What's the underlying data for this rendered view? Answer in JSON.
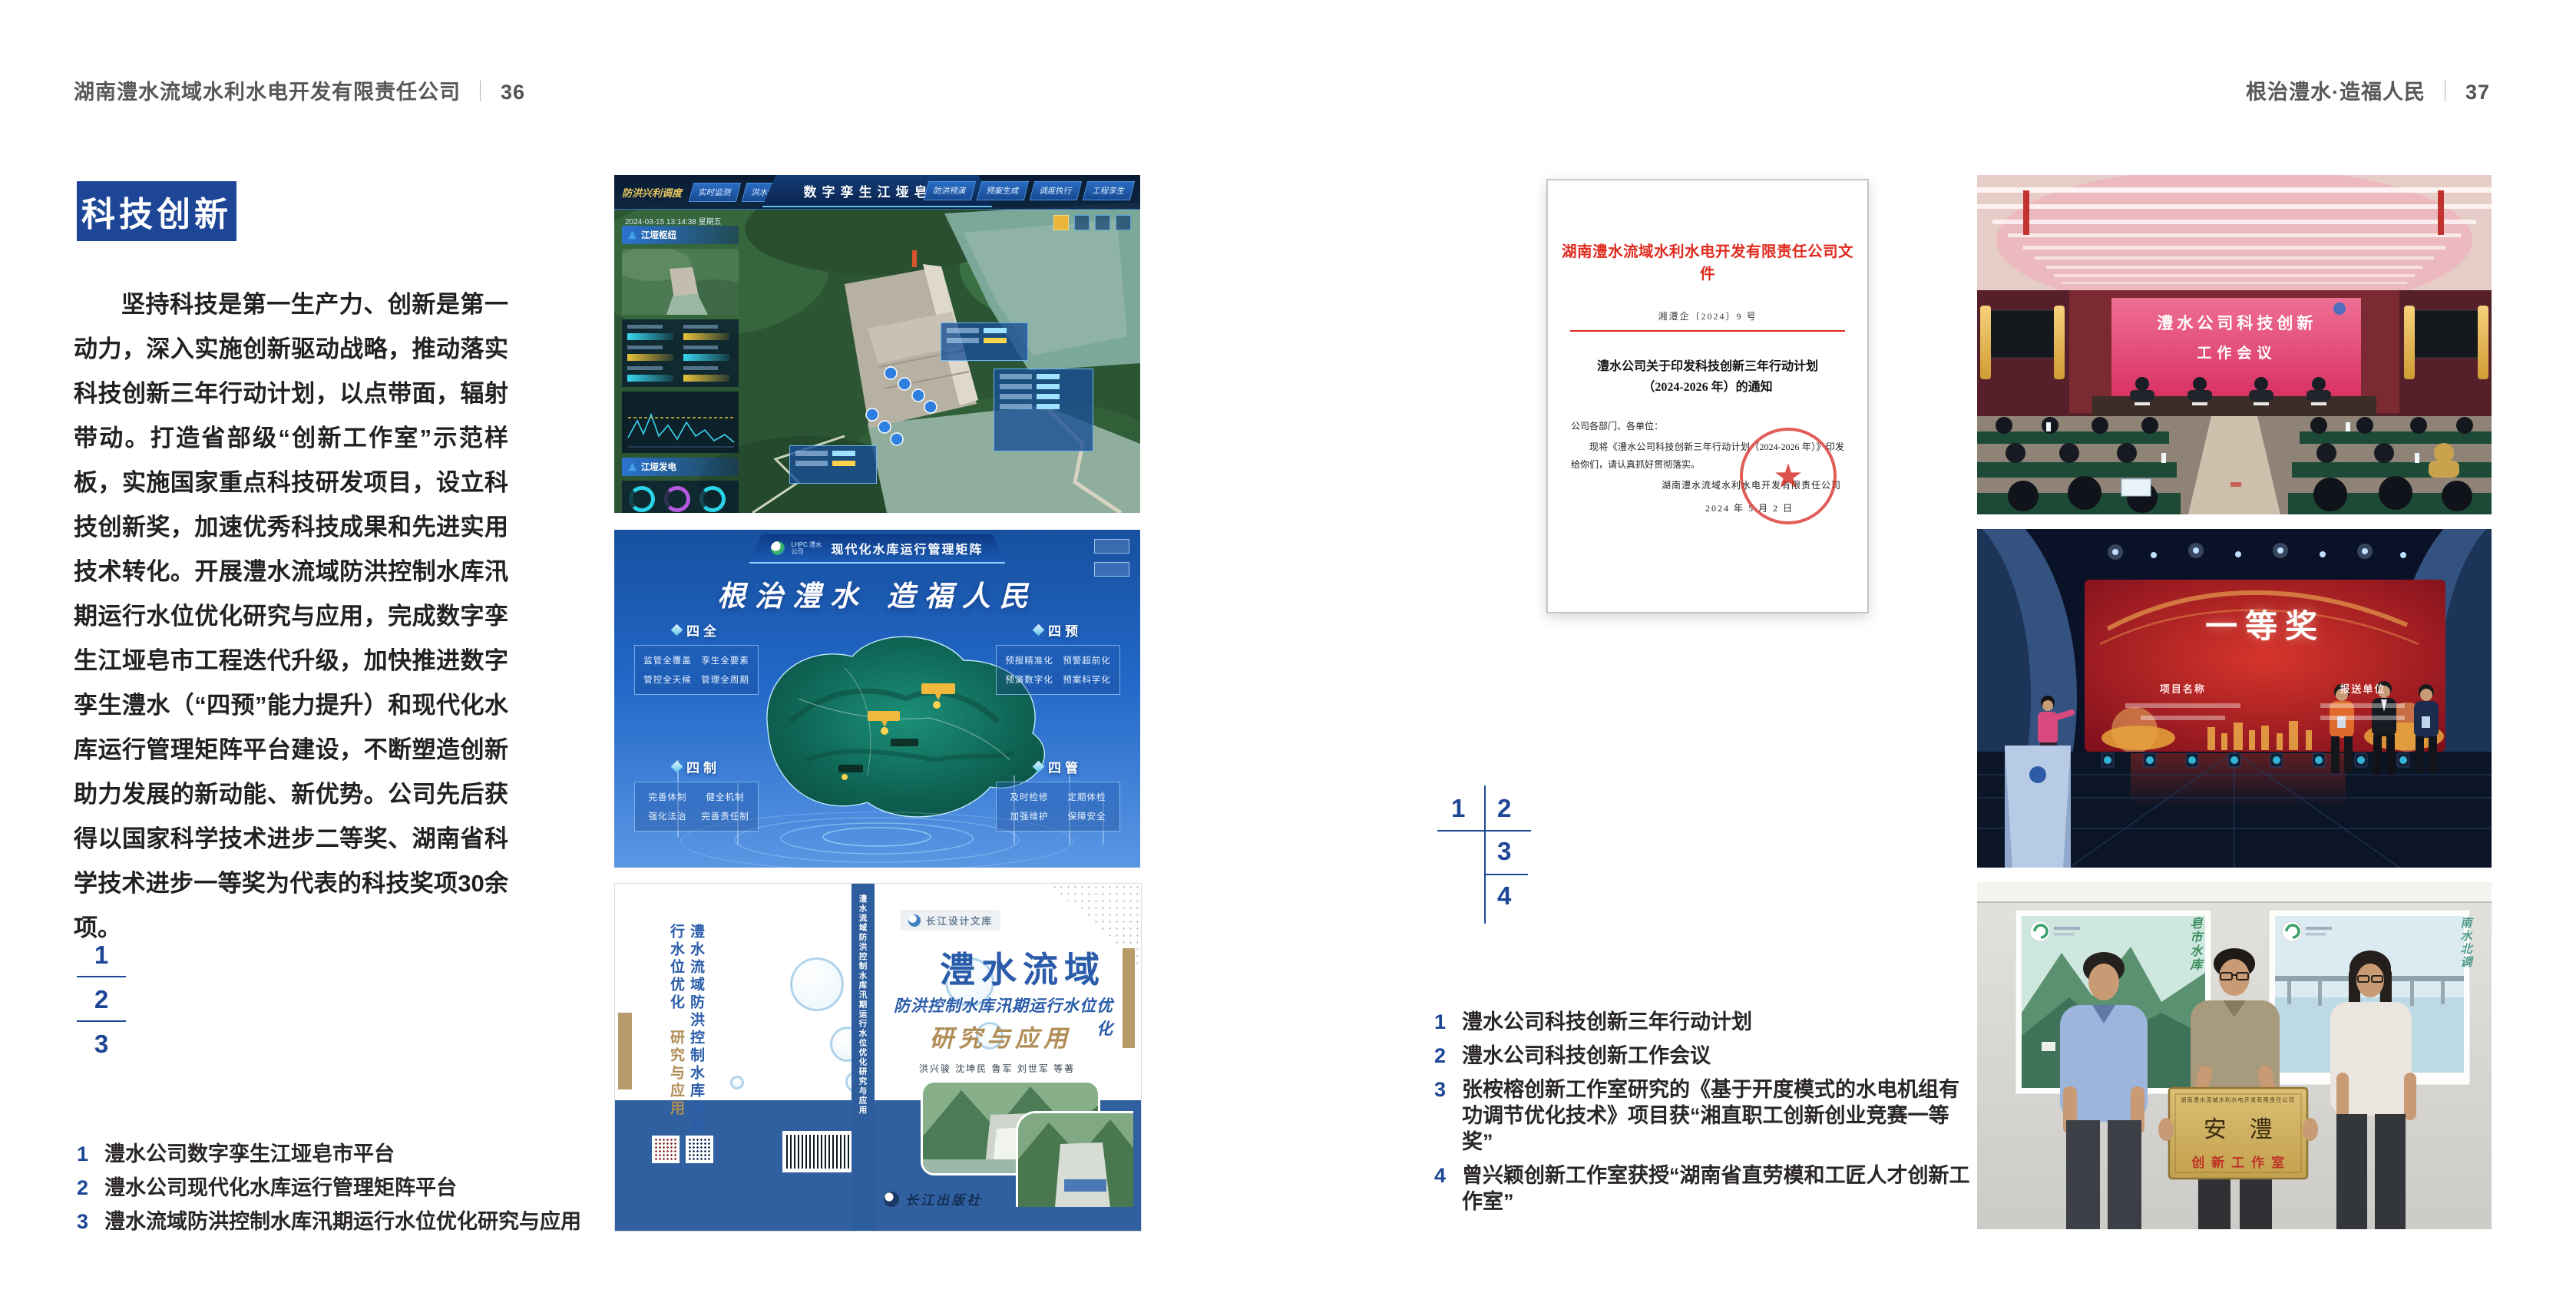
{
  "page_left": {
    "header": {
      "company": "湖南澧水流域水利水电开发有限责任公司",
      "separator": "｜",
      "page_no": "36"
    },
    "badge": "科技创新",
    "paragraph": "坚持科技是第一生产力、创新是第一动力，深入实施创新驱动战略，推动落实科技创新三年行动计划，以点带面，辐射带动。打造省部级“创新工作室”示范样板，实施国家重点科技研发项目，设立科技创新奖，加速优秀科技成果和先进实用技术转化。开展澧水流域防洪控制水库汛期运行水位优化研究与应用，完成数字孪生江垭皂市工程迭代升级，加快推进数字孪生澧水（“四预”能力提升）和现代化水库运行管理矩阵平台建设，不断塑造创新助力发展的新动能、新优势。公司先后获得以国家科学技术进步二等奖、湖南省科学技术进步一等奖为代表的科技奖项30余项。",
    "figure_numbers": [
      "1",
      "2",
      "3"
    ],
    "captions": [
      {
        "no": "1",
        "text": "澧水公司数字孪生江垭皂市平台"
      },
      {
        "no": "2",
        "text": "澧水公司现代化水库运行管理矩阵平台"
      },
      {
        "no": "3",
        "text": "澧水流域防洪控制水库汛期运行水位优化研究与应用"
      }
    ]
  },
  "page_right": {
    "header": {
      "motto": "根治澧水·造福人民",
      "separator": "｜",
      "page_no": "37"
    },
    "figure_numbers": [
      "1",
      "2",
      "3",
      "4"
    ],
    "captions": [
      {
        "no": "1",
        "text": "澧水公司科技创新三年行动计划"
      },
      {
        "no": "2",
        "text": "澧水公司科技创新工作会议"
      },
      {
        "no": "3",
        "text": "张桉榕创新工作室研究的《基于开度模式的水电机组有功调节优化技术》项目获“湘直职工创新创业竞赛一等奖”"
      },
      {
        "no": "4",
        "text": "曾兴颖创新工作室获授“湖南省直劳模和工匠人才创新工作室”"
      }
    ],
    "document": {
      "red_title": "湖南澧水流域水利水电开发有限责任公司文件",
      "doc_no": "湘澧企〔2024〕9 号",
      "subject_line1": "澧水公司关于印发科技创新三年行动计划",
      "subject_line2": "（2024-2026 年）的通知",
      "salutation": "公司各部门、各单位：",
      "body": "现将《澧水公司科技创新三年行动计划（2024-2026 年）》印发给你们，请认真抓好贯彻落实。",
      "signer": "湖南澧水流域水利水电开发有限责任公司",
      "date": "2024 年 5 月 2 日"
    }
  },
  "figures": {
    "digital_twin": {
      "corner_label": "防洪兴利调度",
      "tabs_left": [
        "实时监测",
        "洪水预报",
        "防洪预警"
      ],
      "title": "数字孪生江垭皂市",
      "tabs_right": [
        "防洪预演",
        "预案生成",
        "调度执行",
        "工程孪生"
      ],
      "timestamp": "2024-03-15 13:14:38 星期五",
      "panel_top_title": "江垭枢纽",
      "panel_bottom_title": "江垭发电"
    },
    "matrix": {
      "logo_text": "LHPC 澧水公司",
      "title": "现代化水库运行管理矩阵",
      "slogan": "根治澧水 造福人民",
      "panels": [
        {
          "title": "四全",
          "items": [
            "监管全覆盖",
            "孪生全要素",
            "管控全天候",
            "管理全周期"
          ]
        },
        {
          "title": "四制",
          "items": [
            "完善体制",
            "健全机制",
            "强化法治",
            "完善责任制"
          ]
        },
        {
          "title": "四预",
          "items": [
            "预报精准化",
            "预警超前化",
            "预演数字化",
            "预案科学化"
          ]
        },
        {
          "title": "四管",
          "items": [
            "及时检修",
            "定期体检",
            "加强维护",
            "保障安全"
          ]
        }
      ]
    },
    "book": {
      "series": "长江设计文库",
      "title_main": "澧水流域",
      "title_sub": "防洪控制水库汛期运行水位优化",
      "title_tail": "研究与应用",
      "authors": "洪兴骏 沈坤民 鲁军 刘世军 等著",
      "publisher": "长江出版社",
      "spine_text": "澧水流域防洪控制水库汛期运行水位优化研究与应用",
      "back_title": "澧水流域防洪控制水库汛期运行水位优化",
      "back_tail": "研究与应用"
    },
    "meeting": {
      "screen_line1": "澧水公司科技创新",
      "screen_line2": "工作会议"
    },
    "award": {
      "title": "一等奖",
      "col_left": "项目名称",
      "col_right": "报送单位"
    },
    "plaque": {
      "org_line": "湖南澧水流域水利水电开发有限责任公司",
      "name": "安澧",
      "subtitle": "创新工作室",
      "poster_left_text": "皂市水库",
      "poster_right_text": "南水北调"
    }
  },
  "colors": {
    "accent_blue": "#1d4796",
    "doc_red": "#e02a1e",
    "book_blue": "#2a5caa",
    "book_tan": "#b08d57"
  }
}
